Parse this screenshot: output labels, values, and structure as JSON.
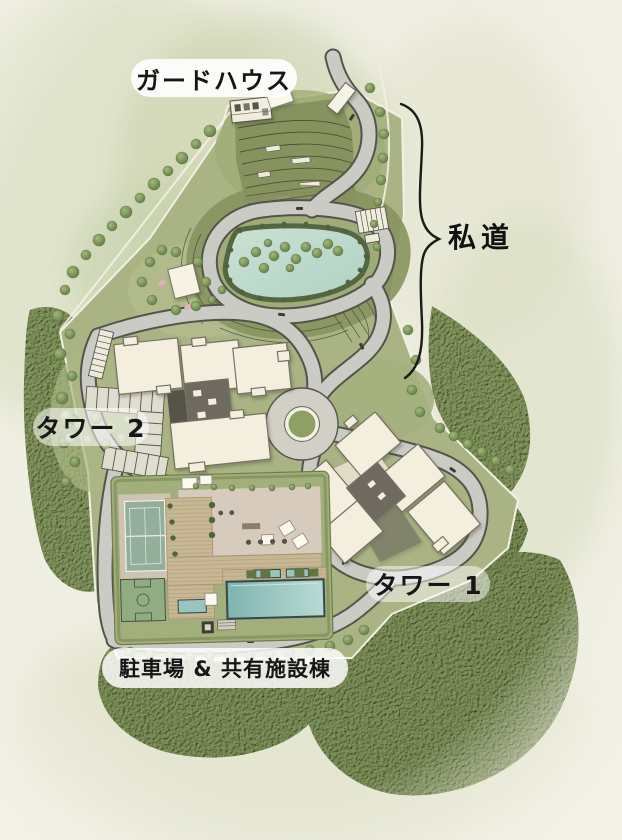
{
  "title": "site-plan",
  "labels": {
    "guard_house": "ガードハウス",
    "private_road": "私道",
    "tower_2": "タワー 2",
    "tower_1": "タワー 1",
    "parking_shared_facilities": "駐車場 & 共有施設棟"
  },
  "features": [
    "guard-house",
    "private-road",
    "pond-loop",
    "roundabout",
    "tower-1-buildings",
    "tower-2-buildings",
    "parking-stalls",
    "tennis-court",
    "basketball-court",
    "swimming-pool",
    "deck",
    "terraced-slopes",
    "forest"
  ],
  "colors": {
    "background": "#EFEEE2",
    "site_green": "#A9B384",
    "lawn_light": "#B2BC8C",
    "terrace_green": "#87935F",
    "road_fill": "#CBCBC6",
    "road_edge": "#55544C",
    "pond": "#BFDCCE",
    "pool": "#9EC6C2",
    "building": "#F3EEDD",
    "building_core": "#6E6A60",
    "deck": "#C8B795",
    "forest": "#7E9159",
    "label_text": "#161616",
    "label_pill": "rgba(255,255,255,0.85)"
  }
}
